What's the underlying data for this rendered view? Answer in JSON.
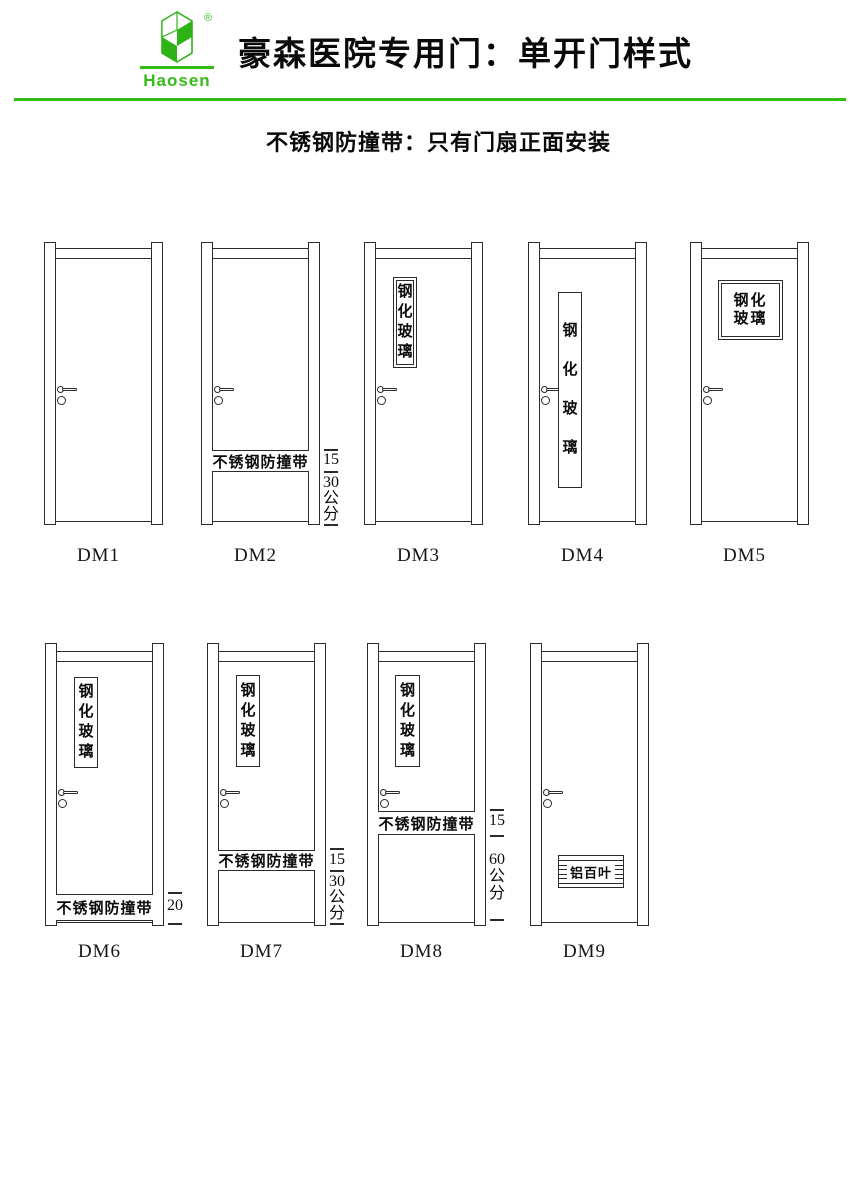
{
  "colors": {
    "accent_green": "#35bd17",
    "logo_green": "#2db315",
    "ink": "#0a0a0a",
    "line": "#2b2b2b"
  },
  "header": {
    "logo": {
      "brand": "Haosen",
      "registered_mark": "®"
    },
    "title": "豪森医院专用门：单开门样式",
    "subtitle": "不锈钢防撞带：只有门扇正面安装"
  },
  "texts": {
    "glass": "钢化玻璃",
    "glass_lines": [
      "钢化",
      "玻璃"
    ],
    "bump_strip": "不锈钢防撞带",
    "louver": "铝百叶",
    "unit": "公分"
  },
  "geometry": {
    "door_width": 119,
    "jamb_width": 12,
    "rail_height": 11,
    "rows": {
      "1": {
        "jamb_top": 242,
        "jamb_bottom": 525,
        "rail_top": 248,
        "leaf_bottom": 521,
        "label_y": 545,
        "handle_y": 386
      },
      "2": {
        "jamb_top": 643,
        "jamb_bottom": 926,
        "rail_top": 651,
        "leaf_bottom": 922,
        "label_y": 941,
        "handle_y": 789
      }
    }
  },
  "doors": [
    {
      "id": "DM1",
      "row": "1",
      "x": 44
    },
    {
      "id": "DM2",
      "row": "1",
      "x": 201,
      "band": {
        "top": 450,
        "bottom": 472
      },
      "dims": [
        {
          "kind": "tick",
          "y": 449
        },
        {
          "kind": "text",
          "y": 452,
          "value": "15"
        },
        {
          "kind": "tick",
          "y": 471
        },
        {
          "kind": "text",
          "y": 475,
          "value": "30"
        },
        {
          "kind": "text",
          "y": 491,
          "value": "公"
        },
        {
          "kind": "text",
          "y": 507,
          "value": "分"
        },
        {
          "kind": "tick",
          "y": 524
        }
      ]
    },
    {
      "id": "DM3",
      "row": "1",
      "x": 364,
      "window": {
        "x": 29,
        "y": 277,
        "w": 24,
        "h": 91,
        "border": "double",
        "layout": "v-tight"
      }
    },
    {
      "id": "DM4",
      "row": "1",
      "x": 528,
      "window": {
        "x": 30,
        "y": 292,
        "w": 24,
        "h": 196,
        "border": "single",
        "layout": "v-spread"
      }
    },
    {
      "id": "DM5",
      "row": "1",
      "x": 690,
      "window": {
        "x": 28,
        "y": 280,
        "w": 65,
        "h": 60,
        "border": "double",
        "layout": "h2"
      }
    },
    {
      "id": "DM6",
      "row": "2",
      "x": 45,
      "window": {
        "x": 29,
        "y": 677,
        "w": 24,
        "h": 91,
        "border": "single",
        "layout": "v-tight"
      },
      "band": {
        "top": 894,
        "bottom": 921
      },
      "dims": [
        {
          "kind": "tick",
          "y": 892
        },
        {
          "kind": "text",
          "y": 898,
          "value": "20"
        },
        {
          "kind": "tick",
          "y": 923
        }
      ]
    },
    {
      "id": "DM7",
      "row": "2",
      "x": 207,
      "window": {
        "x": 29,
        "y": 675,
        "w": 24,
        "h": 92,
        "border": "single",
        "layout": "v-tight"
      },
      "band": {
        "top": 850,
        "bottom": 871
      },
      "dims": [
        {
          "kind": "tick",
          "y": 848
        },
        {
          "kind": "text",
          "y": 852,
          "value": "15"
        },
        {
          "kind": "tick",
          "y": 870
        },
        {
          "kind": "text",
          "y": 874,
          "value": "30"
        },
        {
          "kind": "text",
          "y": 890,
          "value": "公"
        },
        {
          "kind": "text",
          "y": 906,
          "value": "分"
        },
        {
          "kind": "tick",
          "y": 923
        }
      ]
    },
    {
      "id": "DM8",
      "row": "2",
      "x": 367,
      "window": {
        "x": 28,
        "y": 675,
        "w": 25,
        "h": 92,
        "border": "single",
        "layout": "v-tight"
      },
      "band": {
        "top": 811,
        "bottom": 835
      },
      "dims": [
        {
          "kind": "tick",
          "y": 809
        },
        {
          "kind": "text",
          "y": 813,
          "value": "15"
        },
        {
          "kind": "tick",
          "y": 835
        },
        {
          "kind": "text",
          "y": 852,
          "value": "60"
        },
        {
          "kind": "text",
          "y": 869,
          "value": "公"
        },
        {
          "kind": "text",
          "y": 886,
          "value": "分"
        },
        {
          "kind": "tick",
          "y": 919
        }
      ]
    },
    {
      "id": "DM9",
      "row": "2",
      "x": 530,
      "louver": {
        "x": 28,
        "y": 855,
        "w": 66,
        "h": 33
      }
    }
  ]
}
